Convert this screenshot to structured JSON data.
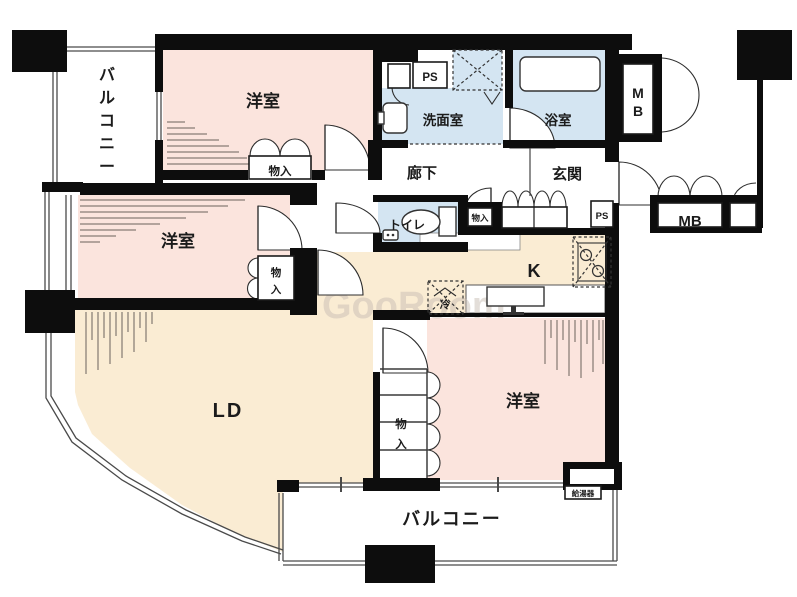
{
  "title": "マンション間取り図",
  "colors": {
    "room_pink": "#fbe4dd",
    "room_cream": "#faecd3",
    "wet_blue": "#d4e5f2",
    "wall": "#0d0d0d"
  },
  "rooms": {
    "western_top": "洋室",
    "western_mid": "洋室",
    "western_bottom": "洋室",
    "living_dining": "LD",
    "kitchen": "K",
    "hallway": "廊下",
    "entrance": "玄関",
    "washroom": "洗面室",
    "bathroom": "浴室",
    "toilet": "トイレ",
    "balcony_bottom": "バルコニー",
    "balcony_side": {
      "text": "バルコニー",
      "chars": [
        "バ",
        "ル",
        "コ",
        "ニ",
        "ー"
      ]
    }
  },
  "fixtures": {
    "closet_top": "物入",
    "closet_mid": {
      "text": "物入",
      "chars": [
        "物",
        "入"
      ]
    },
    "closet_bottom": {
      "text": "物入",
      "chars": [
        "物",
        "入"
      ]
    },
    "closet_hall": "物入",
    "meter_box_top": {
      "text": "MB",
      "chars": [
        "M",
        "B"
      ]
    },
    "meter_box_right": "MB",
    "pipe_space_top": "PS",
    "pipe_space_entrance": "PS",
    "refrigerator": "冷",
    "water_heater": "給湯器"
  },
  "watermark": "GooRoom"
}
